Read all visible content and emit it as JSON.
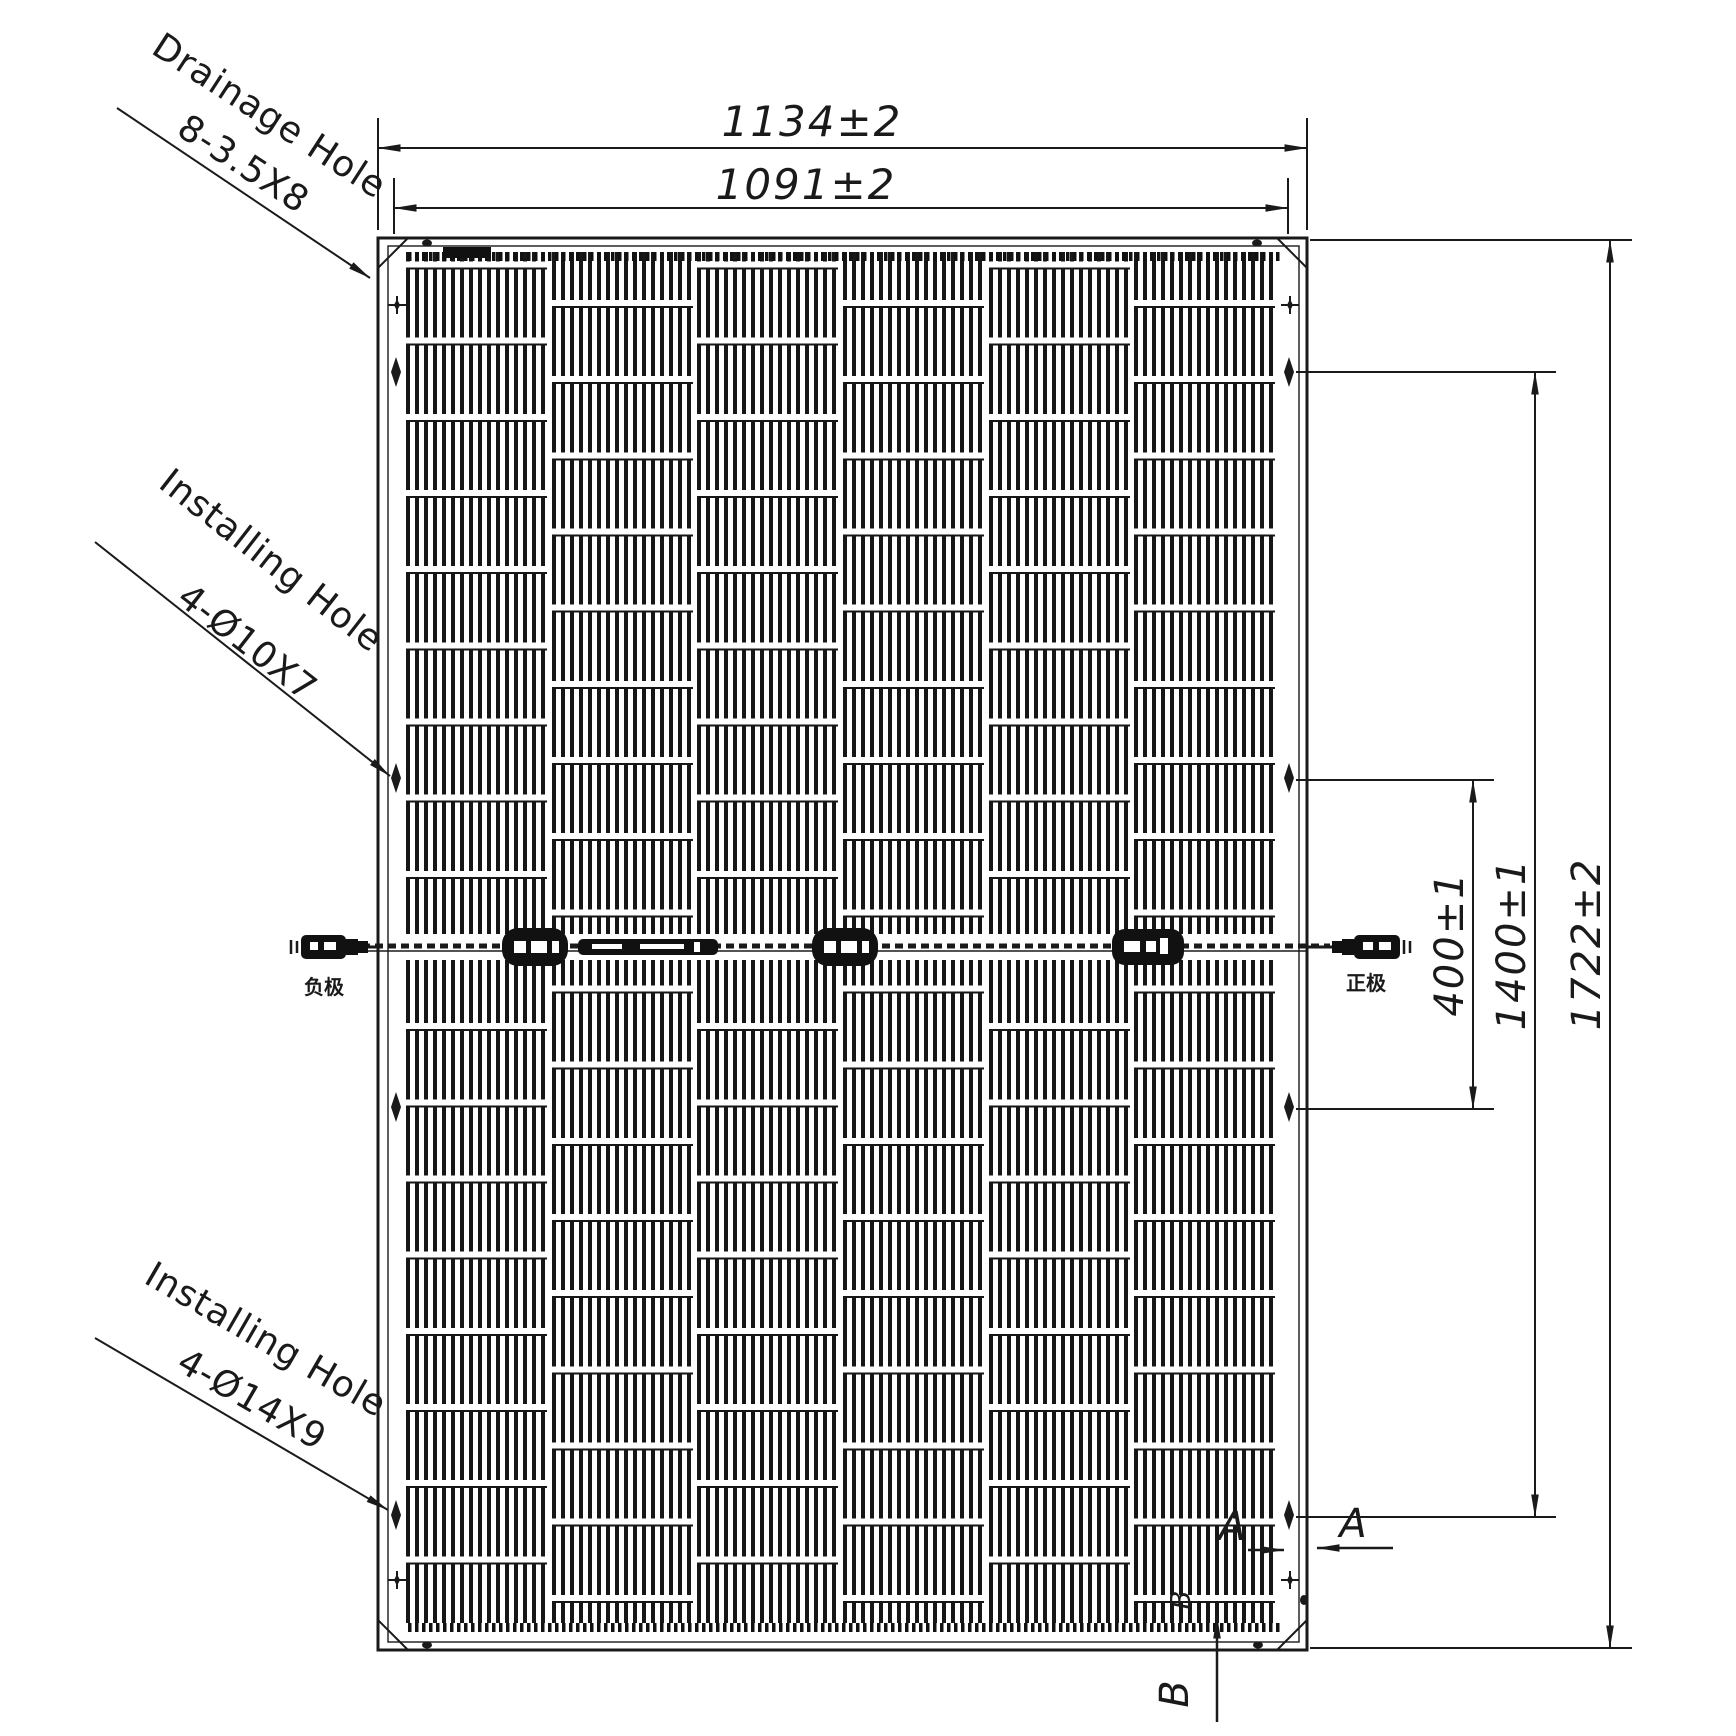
{
  "labels": {
    "drainage": {
      "title": "Drainage Hole",
      "spec": "8-3.5X8"
    },
    "install_upper": {
      "title": "Installing Hole",
      "spec": "4-Ø10X7"
    },
    "install_lower": {
      "title": "Installing Hole",
      "spec": "4-Ø14X9"
    }
  },
  "dims": {
    "outer_width": "1134±2",
    "inner_width": "1091±2",
    "outer_height": "1722±2",
    "hole_span_outer": "1400±1",
    "hole_span_inner": "400±1"
  },
  "connectors": {
    "negative": "负极",
    "positive": "正极"
  },
  "sections": {
    "a": "A",
    "b": "B"
  },
  "panel": {
    "columns": 6,
    "rows": 18
  }
}
